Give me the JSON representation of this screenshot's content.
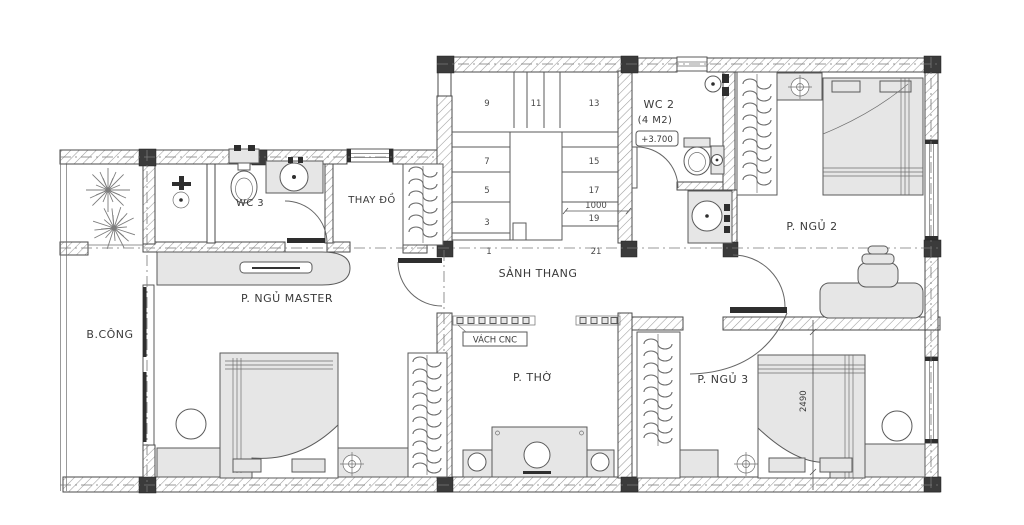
{
  "rooms": {
    "balcony": "B.CÔNG",
    "master_bedroom": "P. NGỦ MASTER",
    "wc3": "WC 3",
    "dressing_room": "THAY ĐỒ",
    "stair_hall": "SẢNH THANG",
    "wc2": "WC 2",
    "wc2_area": "(4 M2)",
    "wc2_level": "+3.700",
    "bedroom2": "P. NGỦ 2",
    "worship_room": "P. THỜ",
    "bedroom3": "P. NGỦ 3",
    "cnc_partition": "VÁCH CNC"
  },
  "stairs": {
    "steps": [
      "9",
      "11",
      "13",
      "7",
      "15",
      "5",
      "17",
      "3",
      "19"
    ],
    "base_steps": [
      "1",
      "21"
    ],
    "width_dim": "1000"
  },
  "dimensions": {
    "bedroom3_bed_width": "2490"
  },
  "colors": {
    "line": "#4a4a4a",
    "hatch": "#9b9b9b",
    "furniture_fill": "#e6e6e6",
    "column_fill": "#3b3b3b",
    "text": "#3a3a3a",
    "background": "#ffffff"
  },
  "icons": {
    "plant-icon": "radial leaf burst",
    "ceiling-fan-icon": "circle with crosshair",
    "toilet-icon": "tank and bowl",
    "sink-icon": "counter with round basin",
    "wardrobe-icon": "rail with hanging garments",
    "door-icon": "leaf with swing arc",
    "window-icon": "double-line opening"
  }
}
